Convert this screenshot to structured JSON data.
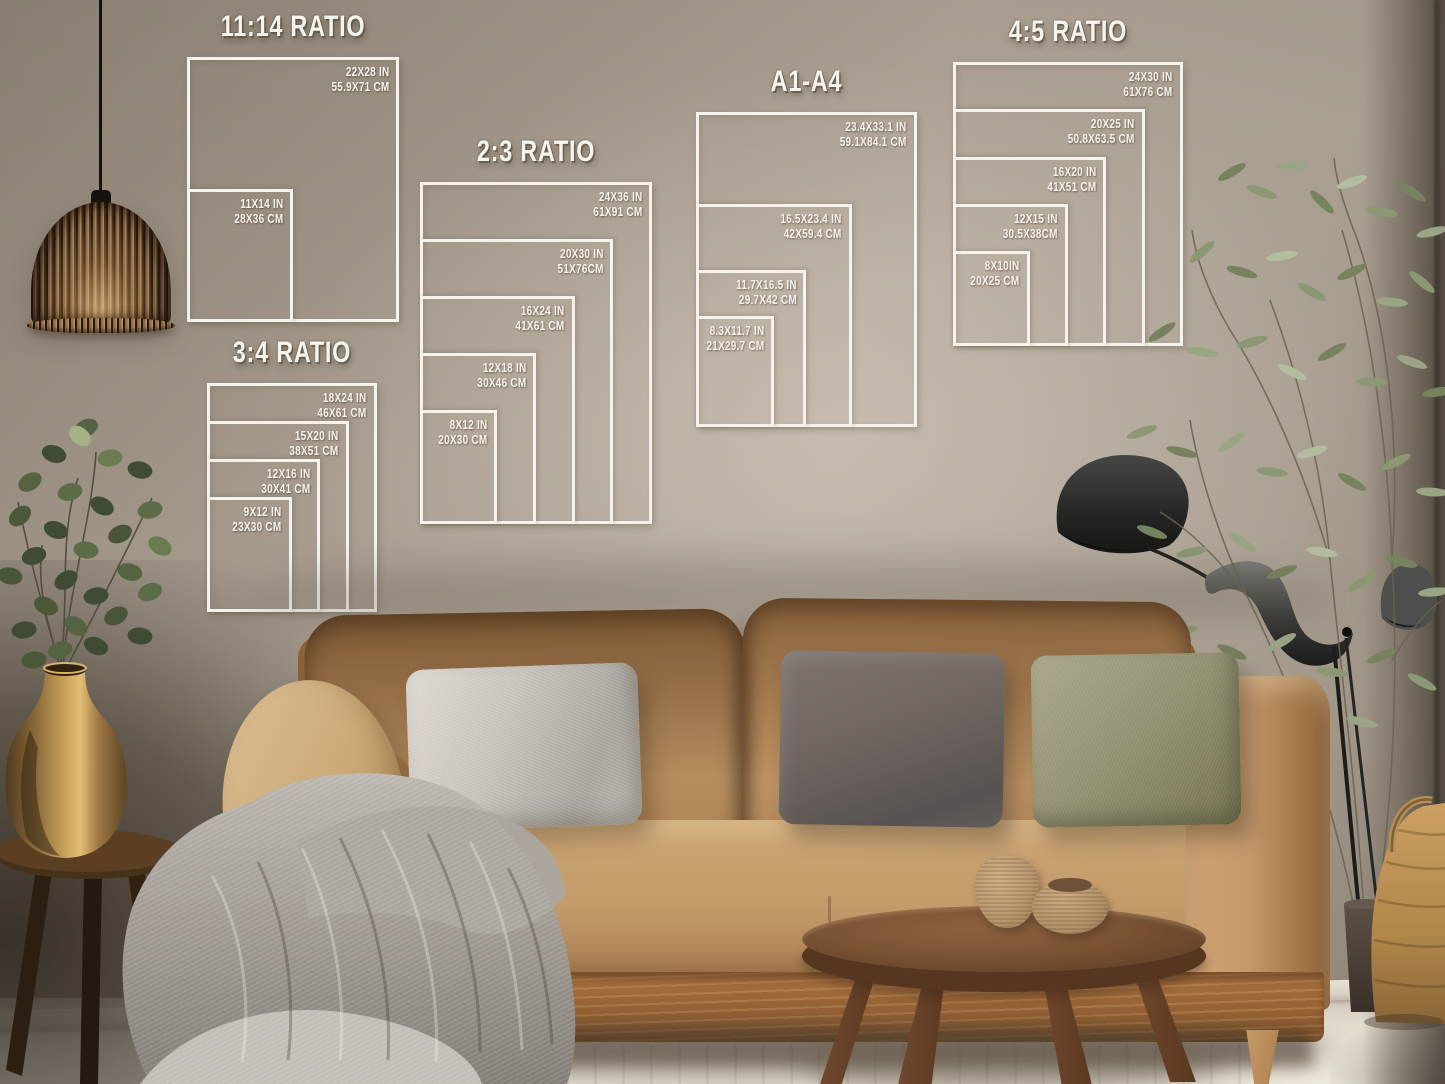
{
  "palette": {
    "wall": "#a79c8e",
    "diagram_line_white": "#f6f3ec",
    "sofa_tan": "#c39b6a",
    "sofa_wood_base": "#9a6536",
    "blanket_gray": "#a8a29b",
    "pillow_silver": "#c6c2bb",
    "pillow_charcoal": "#6f6661",
    "pillow_olive": "#939272",
    "plant_green": "#5c6b48",
    "olive_plant_green": "#8c9874",
    "brass_vase": "#b98f4e",
    "lamp_black": "#2b2b29",
    "table_walnut": "#7b5335",
    "floor": "#e2dccf"
  },
  "diagrams": [
    {
      "id": "ratio-11-14",
      "title": "11:14 RATIO",
      "sizes": [
        {
          "in_label": "22X28 IN",
          "cm_label": "55.9X71 CM",
          "w": 22,
          "h": 28
        },
        {
          "in_label": "11X14 IN",
          "cm_label": "28X36 CM",
          "w": 11,
          "h": 14
        }
      ]
    },
    {
      "id": "ratio-2-3",
      "title": "2:3 RATIO",
      "sizes": [
        {
          "in_label": "24X36 IN",
          "cm_label": "61X91 CM",
          "w": 24,
          "h": 36
        },
        {
          "in_label": "20X30 IN",
          "cm_label": "51X76CM",
          "w": 20,
          "h": 30
        },
        {
          "in_label": "16X24 IN",
          "cm_label": "41X61 CM",
          "w": 16,
          "h": 24
        },
        {
          "in_label": "12X18 IN",
          "cm_label": "30X46 CM",
          "w": 12,
          "h": 18
        },
        {
          "in_label": "8X12 IN",
          "cm_label": "20X30 CM",
          "w": 8,
          "h": 12
        }
      ]
    },
    {
      "id": "ratio-3-4",
      "title": "3:4 RATIO",
      "sizes": [
        {
          "in_label": "18X24 IN",
          "cm_label": "46X61 CM",
          "w": 18,
          "h": 24
        },
        {
          "in_label": "15X20 IN",
          "cm_label": "38X51 CM",
          "w": 15,
          "h": 20
        },
        {
          "in_label": "12X16 IN",
          "cm_label": "30X41 CM",
          "w": 12,
          "h": 16
        },
        {
          "in_label": "9X12 IN",
          "cm_label": "23X30 CM",
          "w": 9,
          "h": 12
        }
      ]
    },
    {
      "id": "a1-a4",
      "title": "A1-A4",
      "sizes": [
        {
          "in_label": "23.4X33.1 IN",
          "cm_label": "59.1X84.1 CM",
          "w": 23.4,
          "h": 33.1
        },
        {
          "in_label": "16.5X23.4 IN",
          "cm_label": "42X59.4 CM",
          "w": 16.5,
          "h": 23.4
        },
        {
          "in_label": "11.7X16.5 IN",
          "cm_label": "29.7X42 CM",
          "w": 11.7,
          "h": 16.5
        },
        {
          "in_label": "8.3X11.7 IN",
          "cm_label": "21X29.7 CM",
          "w": 8.3,
          "h": 11.7
        }
      ]
    },
    {
      "id": "ratio-4-5",
      "title": "4:5 RATIO",
      "sizes": [
        {
          "in_label": "24X30 IN",
          "cm_label": "61X76 CM",
          "w": 24,
          "h": 30
        },
        {
          "in_label": "20X25 IN",
          "cm_label": "50.8X63.5 CM",
          "w": 20,
          "h": 25
        },
        {
          "in_label": "16X20 IN",
          "cm_label": "41X51 CM",
          "w": 16,
          "h": 20
        },
        {
          "in_label": "12X15 IN",
          "cm_label": "30.5X38CM",
          "w": 12,
          "h": 15
        },
        {
          "in_label": "8X10IN",
          "cm_label": "20X25 CM",
          "w": 8,
          "h": 10
        }
      ]
    }
  ]
}
